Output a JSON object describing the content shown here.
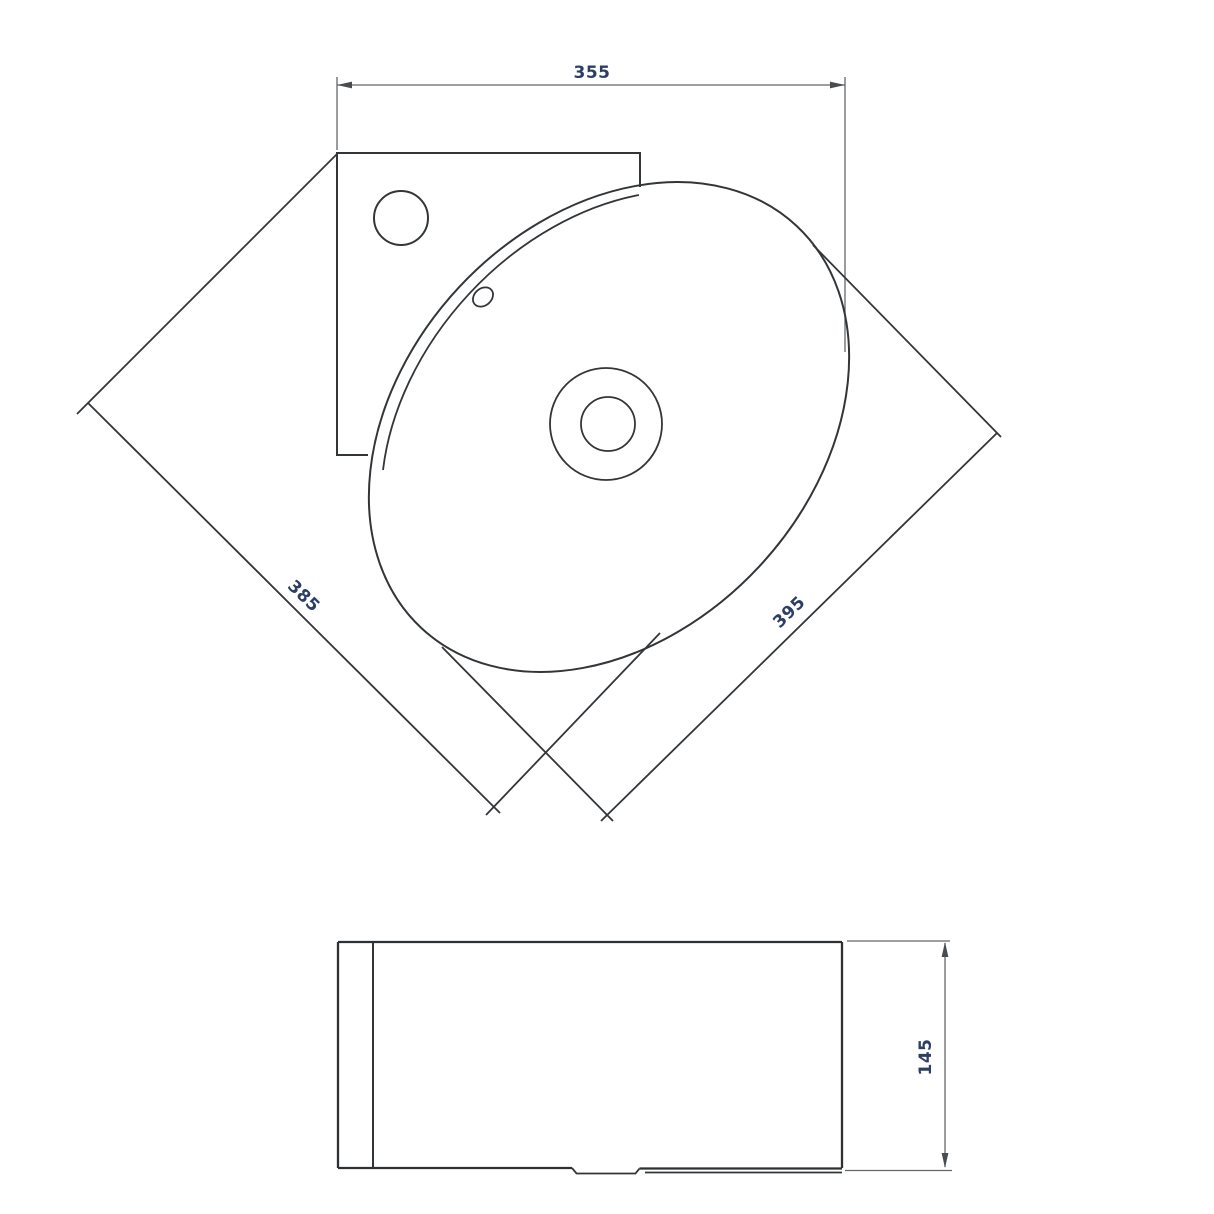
{
  "drawing": {
    "kind": "corner-basin technical drawing",
    "plan": {
      "dim_width": "355",
      "dim_side_left": "385",
      "dim_side_right": "395"
    },
    "elevation": {
      "dim_height": "145"
    },
    "colors": {
      "background": "#ffffff",
      "outline": "#333639",
      "dimension_line": "#63666a",
      "dimension_text": "#2c3e63"
    }
  }
}
